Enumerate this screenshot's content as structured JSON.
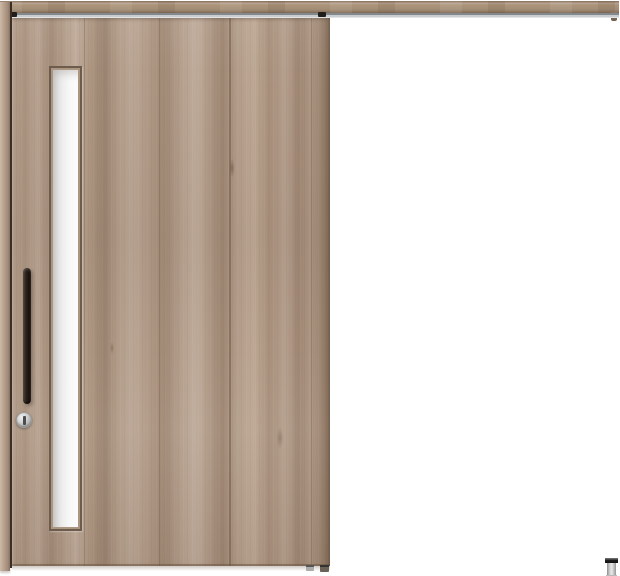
{
  "scene": {
    "description": "Product photo of a closed outset sliding door with a vertical slit glass window, hung from an exposed top rail; open wall section to the right",
    "background_color": "#ffffff"
  },
  "rail": {
    "label": "hanging rail",
    "finish": "wood grain",
    "color": "#a48d75",
    "track_color": "#c9cdcf",
    "end_cap_color": "#7c6a5a"
  },
  "frame": {
    "label": "wall-side vertical frame",
    "color": "#b7a18e",
    "gap_shadow_color": "#3a2e25"
  },
  "door": {
    "label": "sliding door panel",
    "finish": "greige wood grain, vertical grain",
    "base_color": "#ad9683",
    "window": {
      "label": "vertical slit glass window",
      "glass_color": "#f2f2f2",
      "frame_color": "#6d5b4b"
    },
    "handle": {
      "label": "vertical bar handle",
      "color": "#241c16"
    },
    "lock": {
      "label": "round thumbturn lock",
      "body_color": "#cdcdcd",
      "slot_color": "#4c4c4c"
    }
  },
  "hardware": {
    "hanger_roller_color": "#211d19",
    "bottom_guide_colors": [
      "#ababab",
      "#6b6257"
    ],
    "floor_guide": {
      "label": "floor guide / door stop",
      "cap_color": "#1e1e1e",
      "body_color": "#d8d8d8"
    }
  }
}
